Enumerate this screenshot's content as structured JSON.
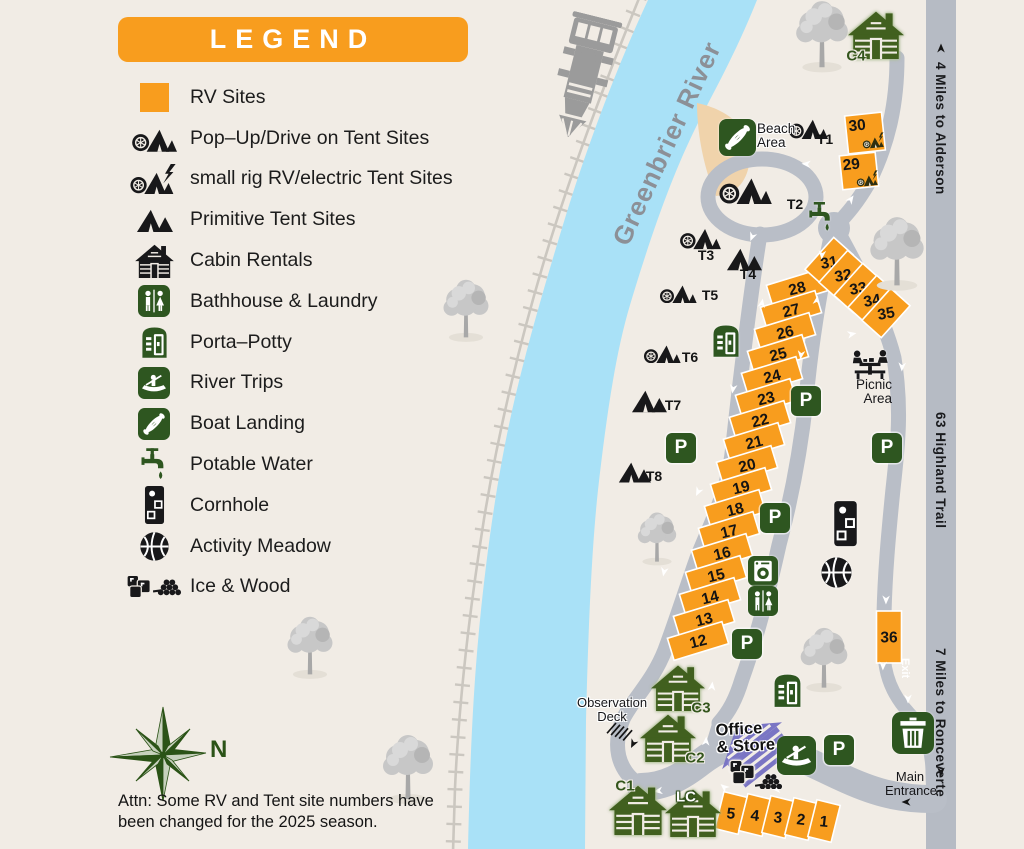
{
  "palette": {
    "orange": "#F89D1E",
    "sign_green": "#2E5620",
    "cabin_green": "#41601F",
    "river_blue": "#A9E1F7",
    "road_gray": "#B9BEC7",
    "bg_beige": "#F1ECE5",
    "beach_tan": "#F0D3AB",
    "office_purple": "#7A75C4",
    "rail_gray": "#CBC7C0",
    "black": "#17171A"
  },
  "legend": {
    "title": "LEGEND",
    "items": [
      {
        "icon": "rv-square",
        "label": "RV Sites"
      },
      {
        "icon": "popup-tent-icon",
        "label": "Pop–Up/Drive on Tent Sites"
      },
      {
        "icon": "small-rig-icon",
        "label": "small rig RV/electric Tent Sites"
      },
      {
        "icon": "primitive-tent-icon",
        "label": "Primitive Tent Sites"
      },
      {
        "icon": "cabin-icon",
        "label": "Cabin Rentals"
      },
      {
        "icon": "bathhouse-icon",
        "label": "Bathhouse & Laundry"
      },
      {
        "icon": "porta-potty-icon",
        "label": "Porta–Potty"
      },
      {
        "icon": "river-trips-icon",
        "label": "River Trips"
      },
      {
        "icon": "boat-landing-icon",
        "label": "Boat Landing"
      },
      {
        "icon": "potable-water-icon",
        "label": "Potable Water"
      },
      {
        "icon": "cornhole-icon",
        "label": "Cornhole"
      },
      {
        "icon": "activity-meadow-icon",
        "label": "Activity Meadow"
      },
      {
        "icon": "ice-wood-icon",
        "label": "Ice & Wood"
      }
    ]
  },
  "compass": {
    "north_label": "N"
  },
  "attention_note": "Attn: Some RV and Tent site numbers have been changed for the 2025 season.",
  "river_label": "Greenbrier River",
  "signs": {
    "alderson": "4 Miles to Alderson",
    "highland_trail": "63  Highland Trail",
    "ronceverte": "7 Miles to Ronceverte",
    "exit": "Exit",
    "main_entrance": [
      "Main",
      "Entrance"
    ]
  },
  "area_labels": {
    "beach": [
      "Beach",
      "Area"
    ],
    "picnic": [
      "Picnic",
      "Area"
    ],
    "observation": [
      "Observation",
      "Deck"
    ],
    "office": [
      "Office",
      "& Store"
    ]
  },
  "parking_label": "P",
  "rv_sites": [
    {
      "n": "28",
      "x": 797,
      "y": 288,
      "w": 57,
      "h": 23,
      "r": -17,
      "tr": -14
    },
    {
      "n": "27",
      "x": 791,
      "y": 310,
      "w": 57,
      "h": 23,
      "r": -17,
      "tr": -14
    },
    {
      "n": "26",
      "x": 785,
      "y": 332,
      "w": 57,
      "h": 23,
      "r": -17,
      "tr": -14
    },
    {
      "n": "25",
      "x": 778,
      "y": 354,
      "w": 57,
      "h": 23,
      "r": -17,
      "tr": -14
    },
    {
      "n": "24",
      "x": 772,
      "y": 376,
      "w": 57,
      "h": 23,
      "r": -17,
      "tr": -14
    },
    {
      "n": "23",
      "x": 766,
      "y": 398,
      "w": 57,
      "h": 23,
      "r": -17,
      "tr": -14
    },
    {
      "n": "22",
      "x": 760,
      "y": 420,
      "w": 57,
      "h": 23,
      "r": -17,
      "tr": -14
    },
    {
      "n": "21",
      "x": 754,
      "y": 442,
      "w": 57,
      "h": 23,
      "r": -17,
      "tr": -14
    },
    {
      "n": "20",
      "x": 747,
      "y": 465,
      "w": 57,
      "h": 23,
      "r": -17,
      "tr": -14
    },
    {
      "n": "19",
      "x": 741,
      "y": 487,
      "w": 57,
      "h": 23,
      "r": -17,
      "tr": -14
    },
    {
      "n": "18",
      "x": 735,
      "y": 509,
      "w": 57,
      "h": 23,
      "r": -17,
      "tr": -14
    },
    {
      "n": "17",
      "x": 729,
      "y": 531,
      "w": 57,
      "h": 23,
      "r": -17,
      "tr": -14
    },
    {
      "n": "16",
      "x": 722,
      "y": 553,
      "w": 57,
      "h": 23,
      "r": -17,
      "tr": -14
    },
    {
      "n": "15",
      "x": 716,
      "y": 575,
      "w": 57,
      "h": 23,
      "r": -17,
      "tr": -14
    },
    {
      "n": "14",
      "x": 710,
      "y": 597,
      "w": 57,
      "h": 23,
      "r": -17,
      "tr": -14
    },
    {
      "n": "13",
      "x": 704,
      "y": 619,
      "w": 57,
      "h": 23,
      "r": -17,
      "tr": -14
    },
    {
      "n": "12",
      "x": 698,
      "y": 641,
      "w": 57,
      "h": 23,
      "r": -17,
      "tr": -14
    },
    {
      "n": "31",
      "x": 829,
      "y": 262,
      "w": 43,
      "h": 26,
      "r": -48,
      "tr": -10
    },
    {
      "n": "32",
      "x": 843,
      "y": 275,
      "w": 43,
      "h": 26,
      "r": -48,
      "tr": -10
    },
    {
      "n": "33",
      "x": 858,
      "y": 288,
      "w": 43,
      "h": 26,
      "r": -48,
      "tr": -10
    },
    {
      "n": "34",
      "x": 872,
      "y": 300,
      "w": 43,
      "h": 26,
      "r": -48,
      "tr": -10
    },
    {
      "n": "35",
      "x": 886,
      "y": 313,
      "w": 43,
      "h": 26,
      "r": -48,
      "tr": -10
    },
    {
      "n": "30",
      "x": 865,
      "y": 133,
      "w": 37,
      "h": 38,
      "r": -6,
      "tr": -6,
      "nx": -7,
      "ny": -9,
      "icon": true
    },
    {
      "n": "29",
      "x": 859,
      "y": 171,
      "w": 36,
      "h": 34,
      "r": -6,
      "tr": -6,
      "nx": -7,
      "ny": -8,
      "icon": true
    },
    {
      "n": "36",
      "x": 889,
      "y": 637,
      "w": 25,
      "h": 52,
      "r": 0,
      "tr": 0
    },
    {
      "n": "5",
      "x": 731,
      "y": 813,
      "w": 24,
      "h": 38,
      "r": 14,
      "tr": 6
    },
    {
      "n": "4",
      "x": 755,
      "y": 815,
      "w": 24,
      "h": 38,
      "r": 14,
      "tr": 6
    },
    {
      "n": "3",
      "x": 778,
      "y": 817,
      "w": 24,
      "h": 38,
      "r": 14,
      "tr": 6
    },
    {
      "n": "2",
      "x": 801,
      "y": 819,
      "w": 24,
      "h": 38,
      "r": 14,
      "tr": 6
    },
    {
      "n": "1",
      "x": 824,
      "y": 821,
      "w": 24,
      "h": 38,
      "r": 14,
      "tr": 6
    }
  ],
  "tent_sites": [
    {
      "id": "T1",
      "type": "popup",
      "x": 808,
      "y": 127,
      "s": 40,
      "lx": 825,
      "ly": 139
    },
    {
      "id": "T2",
      "type": "popup",
      "x": 745,
      "y": 188,
      "s": 54,
      "lx": 795,
      "ly": 204
    },
    {
      "id": "T3",
      "type": "popup",
      "x": 700,
      "y": 237,
      "s": 42,
      "lx": 706,
      "ly": 255
    },
    {
      "id": "T4",
      "type": "primitive",
      "x": 744,
      "y": 259,
      "s": 36,
      "lx": 748,
      "ly": 274
    },
    {
      "id": "T5",
      "type": "popup",
      "x": 678,
      "y": 292,
      "s": 38,
      "lx": 710,
      "ly": 295
    },
    {
      "id": "T6",
      "type": "popup",
      "x": 662,
      "y": 352,
      "s": 38,
      "lx": 690,
      "ly": 357
    },
    {
      "id": "T7",
      "type": "primitive",
      "x": 649,
      "y": 401,
      "s": 36,
      "lx": 673,
      "ly": 405
    },
    {
      "id": "T8",
      "type": "primitive",
      "x": 634,
      "y": 472,
      "s": 33,
      "lx": 654,
      "ly": 476
    }
  ],
  "cabins": [
    {
      "id": "C4",
      "x": 876,
      "y": 34,
      "s": 56,
      "lx": 856,
      "ly": 56,
      "style": "green"
    },
    {
      "id": "C3",
      "x": 678,
      "y": 687,
      "s": 54,
      "lx": 701,
      "ly": 708,
      "style": "green"
    },
    {
      "id": "C2",
      "x": 668,
      "y": 737,
      "s": 56,
      "lx": 695,
      "ly": 758,
      "style": "green"
    },
    {
      "id": "C1",
      "x": 638,
      "y": 809,
      "s": 58,
      "lx": 625,
      "ly": 786,
      "style": "green"
    },
    {
      "id": "LC",
      "x": 693,
      "y": 812,
      "s": 56,
      "lx": 686,
      "ly": 797,
      "style": "white"
    }
  ],
  "parking_spots": [
    {
      "x": 681,
      "y": 448
    },
    {
      "x": 806,
      "y": 401
    },
    {
      "x": 887,
      "y": 448
    },
    {
      "x": 775,
      "y": 518
    },
    {
      "x": 747,
      "y": 644
    },
    {
      "x": 839,
      "y": 750
    }
  ],
  "amenities": [
    {
      "icon": "boat-landing",
      "x": 737,
      "y": 137,
      "s": 37
    },
    {
      "icon": "potable-water",
      "x": 821,
      "y": 217,
      "s": 28
    },
    {
      "icon": "porta-potty",
      "x": 726,
      "y": 340,
      "s": 30
    },
    {
      "icon": "porta-potty",
      "x": 787,
      "y": 690,
      "s": 31
    },
    {
      "icon": "laundry",
      "x": 763,
      "y": 571,
      "s": 30
    },
    {
      "icon": "bathhouse",
      "x": 763,
      "y": 601,
      "s": 30
    },
    {
      "icon": "cornhole",
      "x": 845,
      "y": 524,
      "s": 27
    },
    {
      "icon": "basketball",
      "x": 836,
      "y": 572,
      "s": 33
    },
    {
      "icon": "river-trips",
      "x": 796,
      "y": 755,
      "s": 39
    },
    {
      "icon": "trash",
      "x": 913,
      "y": 733,
      "s": 42
    },
    {
      "icon": "picnic",
      "x": 870,
      "y": 364,
      "s": 42
    },
    {
      "icon": "ice",
      "x": 743,
      "y": 772,
      "s": 28
    },
    {
      "icon": "wood",
      "x": 769,
      "y": 781,
      "s": 28
    }
  ],
  "trees": [
    {
      "x": 822,
      "y": 33,
      "s": 62
    },
    {
      "x": 897,
      "y": 250,
      "s": 64
    },
    {
      "x": 466,
      "y": 308,
      "s": 54
    },
    {
      "x": 657,
      "y": 536,
      "s": 46
    },
    {
      "x": 824,
      "y": 657,
      "s": 56
    },
    {
      "x": 310,
      "y": 645,
      "s": 54
    },
    {
      "x": 408,
      "y": 766,
      "s": 60
    }
  ],
  "train": {
    "x": 583,
    "y": 77,
    "s": 62,
    "r": 14
  }
}
